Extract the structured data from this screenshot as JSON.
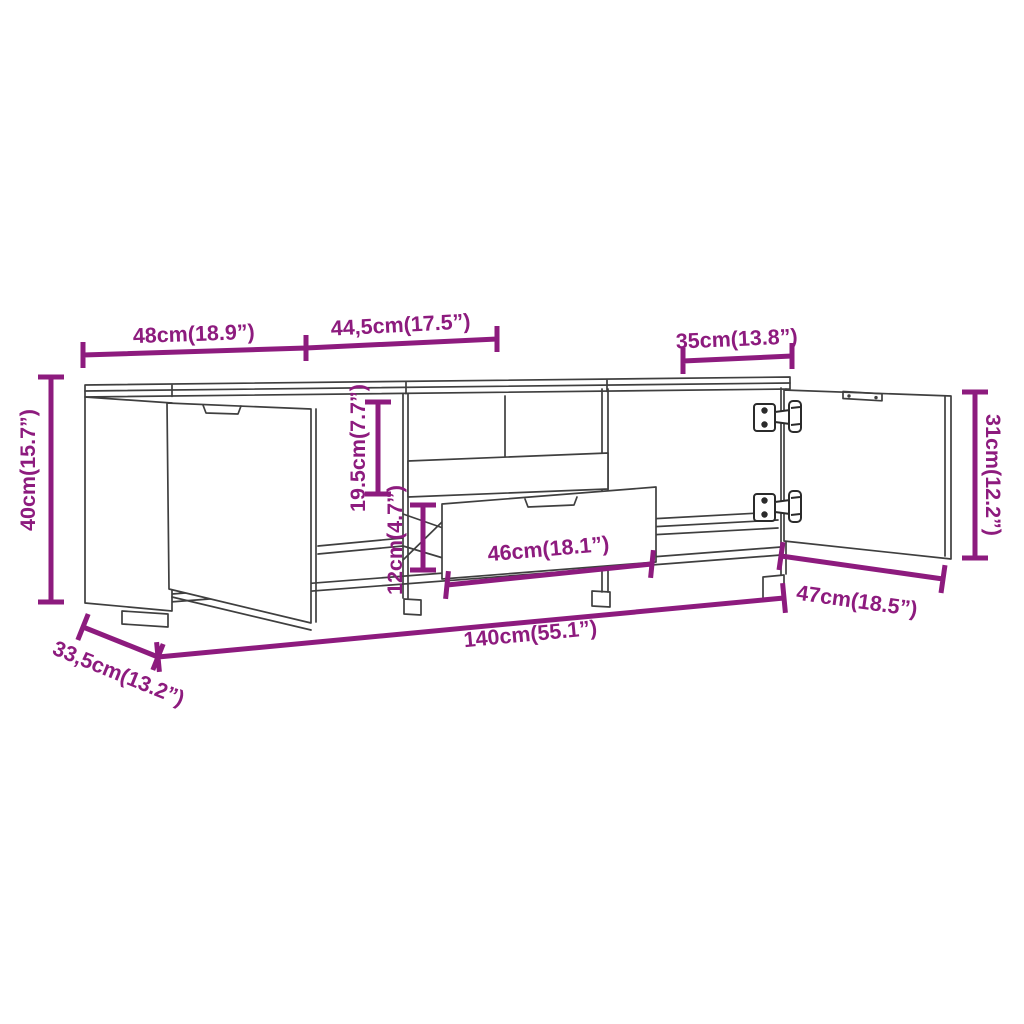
{
  "diagram": {
    "type": "furniture-dimension-diagram",
    "subject": "TV cabinet line drawing with open right door and pulled-out drawer",
    "background": "#ffffff",
    "accent_color": "#8d1b7e",
    "line_color": "#3f3f3f",
    "hinge_color": "#2b2b2b"
  },
  "dimensions": {
    "top_left_width": {
      "label": "48cm(18.9”)"
    },
    "top_middle_width": {
      "label": "44,5cm(17.5”)"
    },
    "top_right_width": {
      "label": "35cm(13.8”)"
    },
    "overall_height": {
      "label": "40cm(15.7”)"
    },
    "compartment_height": {
      "label": "19.5cm(7.7”)"
    },
    "drawer_gap_height": {
      "label": "12cm(4.7”)"
    },
    "drawer_width": {
      "label": "46cm(18.1”)"
    },
    "door_height": {
      "label": "31cm(12.2”)"
    },
    "door_width": {
      "label": "47cm(18.5”)"
    },
    "overall_width": {
      "label": "140cm(55.1”)"
    },
    "overall_depth": {
      "label": "33,5cm(13.2”)"
    }
  }
}
